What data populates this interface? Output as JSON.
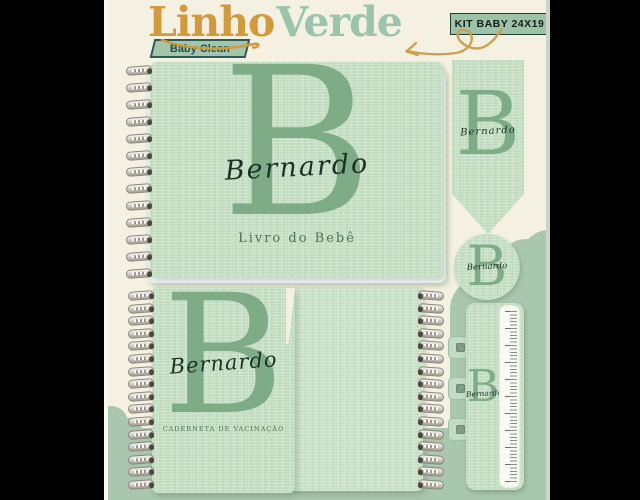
{
  "brand": {
    "name_part1": "Linho",
    "name_part2": "Verde",
    "tagline": "Baby Clean"
  },
  "kit_badge": {
    "label": "KIT BABY 24X19"
  },
  "personalization": {
    "monogram": "B",
    "name": "Bernardo"
  },
  "items": {
    "baby_book": {
      "monogram": "B",
      "name": "Bernardo",
      "caption": "Livro do Bebê"
    },
    "bookmark": {
      "monogram": "B",
      "name": "Bernardo"
    },
    "round_tag": {
      "monogram": "B",
      "name": "Bernardo"
    },
    "vaccination_book": {
      "monogram": "B",
      "name": "Bernardo",
      "caption": "CADERNETA DE VACINAÇÃO"
    },
    "ruler": {
      "monogram": "B",
      "name": "Bernardo"
    }
  },
  "colors": {
    "letterbox": "#000000",
    "background_cream": "#F5F1E2",
    "linen_green": "#C3DEC2",
    "monogram_green": "#7EAC86",
    "logo_gold": "#D19A3E",
    "logo_green": "#9AC4AC",
    "badge_green": "#9CC2A7",
    "badge_teal": "#2E5B52",
    "cloud_green": "#A9C6AE",
    "script_ink": "#1C3226",
    "caption_green": "#4F7158"
  }
}
